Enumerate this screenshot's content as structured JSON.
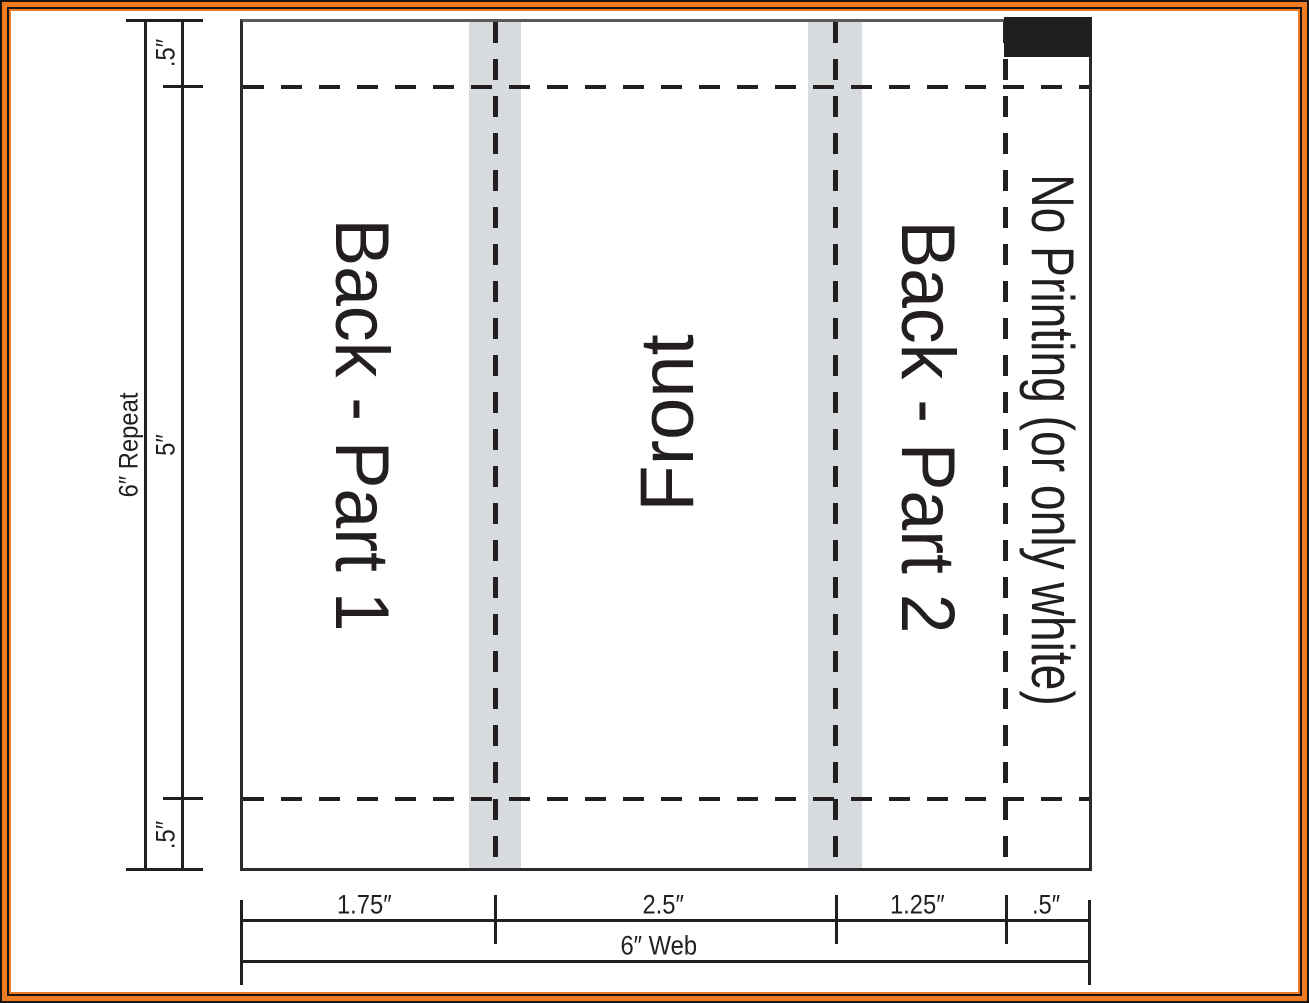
{
  "diagram": {
    "title_hint": "packaging web layout template",
    "panels": [
      {
        "label": "Back - Part 1"
      },
      {
        "label": "Front"
      },
      {
        "label": "Back - Part 2"
      },
      {
        "label": "No Printing (or only white)"
      }
    ],
    "repeat_dimension": {
      "total": "6″ Repeat",
      "segments": [
        ".5″",
        "5″",
        ".5″"
      ]
    },
    "web_dimension": {
      "total": "6″ Web",
      "segments": [
        "1.75″",
        "2.5″",
        "1.25″",
        ".5″"
      ]
    },
    "colors": {
      "frame_orange": "#ef7b23",
      "frame_black": "#181512",
      "line_black": "#231f20",
      "box_top_gray": "#58595b",
      "seal_band_gray": "#d8dbde",
      "eye_mark_black": "#1f1f21"
    }
  }
}
